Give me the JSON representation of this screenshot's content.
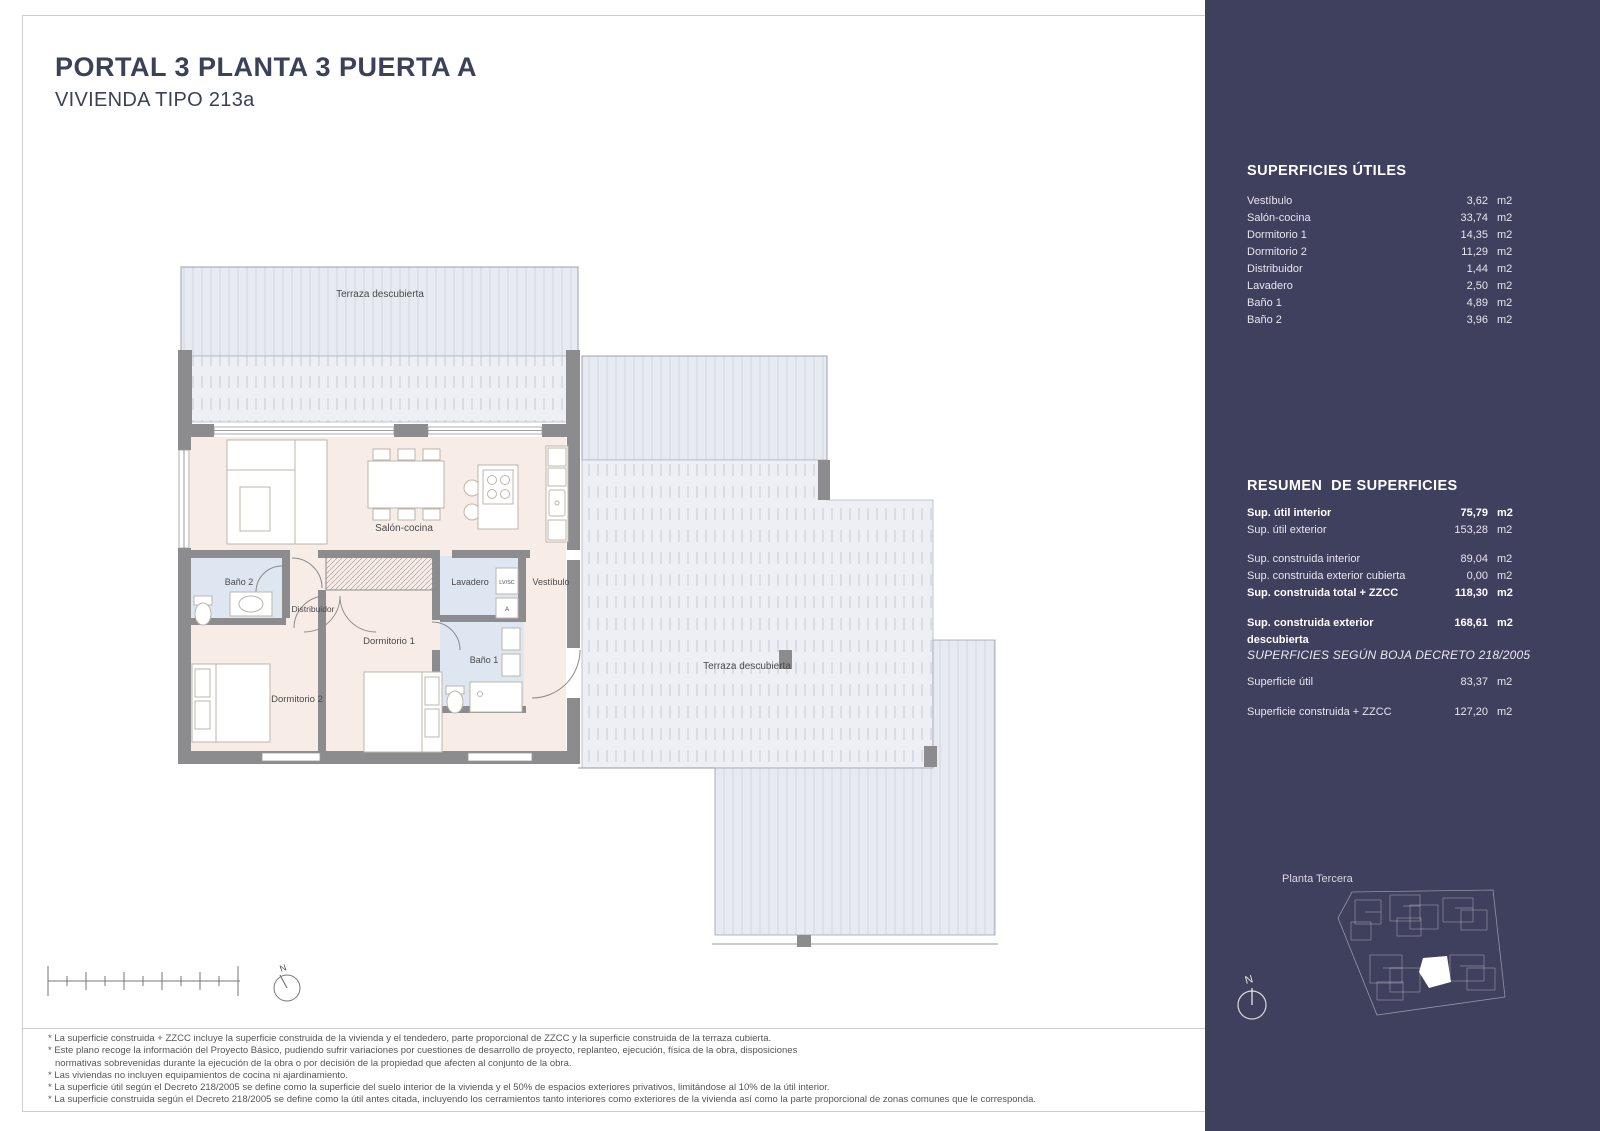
{
  "header": {
    "title": "PORTAL 3  PLANTA 3 PUERTA A",
    "subtitle": "VIVIENDA TIPO 213a"
  },
  "plan": {
    "rooms": {
      "terraza_top": "Terraza descubierta",
      "salon": "Salón-cocina",
      "bano2": "Baño 2",
      "distribuidor": "Distribuidor",
      "lavadero": "Lavadero",
      "vestibulo": "Vestíbulo",
      "dormitorio1": "Dormitorio 1",
      "bano1": "Baño 1",
      "dormitorio2": "Dormitorio 2",
      "terraza_right": "Terraza descubierta"
    },
    "appliances": {
      "washer": "LV/SC",
      "boiler": "A"
    },
    "north_letter": "N"
  },
  "sidebar": {
    "unit": "m2",
    "superficies_utiles": {
      "title": "SUPERFICIES ÚTILES",
      "rows": [
        {
          "label": "Vestíbulo",
          "value": "3,62"
        },
        {
          "label": "Salón-cocina",
          "value": "33,74"
        },
        {
          "label": "Dormitorio 1",
          "value": "14,35"
        },
        {
          "label": "Dormitorio 2",
          "value": "11,29"
        },
        {
          "label": "Distribuidor",
          "value": "1,44"
        },
        {
          "label": "Lavadero",
          "value": "2,50"
        },
        {
          "label": "Baño 1",
          "value": "4,89"
        },
        {
          "label": "Baño 2",
          "value": "3,96"
        }
      ]
    },
    "resumen": {
      "title": "RESUMEN  DE SUPERFICIES",
      "rows": [
        {
          "label": "Sup. útil interior",
          "value": "75,79"
        },
        {
          "label": "Sup. útil exterior",
          "value": "153,28"
        },
        {
          "label": "Sup. construida interior",
          "value": "89,04"
        },
        {
          "label": "Sup. construida exterior cubierta",
          "value": "0,00"
        },
        {
          "label": "Sup. construida total + ZZCC",
          "value": "118,30"
        },
        {
          "label": "Sup. construida exterior descubierta",
          "value": "168,61"
        }
      ]
    },
    "boja": {
      "title": "SUPERFICIES SEGÚN BOJA DECRETO 218/2005",
      "rows": [
        {
          "label": "Superficie útil",
          "value": "83,37"
        },
        {
          "label": "Superficie construida + ZZCC",
          "value": "127,20"
        }
      ]
    },
    "site_plan": {
      "label": "Planta Tercera",
      "north_letter": "N"
    }
  },
  "footnotes": [
    "* La superficie construida + ZZCC incluye la superficie construida de la vivienda y el tendedero, parte proporcional de ZZCC y la superficie construida de la terraza cubierta.",
    "* Este plano recoge la información del Proyecto Básico, pudiendo sufrir variaciones por cuestiones de desarrollo de proyecto, replanteo, ejecución, física de la obra, disposiciones",
    "normativas sobrevenidas durante la ejecución de la obra o por decisión de la propiedad que afecten al conjunto de la obra.",
    "* Las viviendas no incluyen equipamientos de cocina ni ajardinamiento.",
    "* La superficie útil según el Decreto 218/2005 se define como la superficie del suelo interior de la vivienda y el 50% de espacios exteriores privativos, limitándose al 10% de la útil interior.",
    "* La superficie construida según el Decreto 218/2005 se define como la útil antes citada, incluyendo los cerramientos tanto interiores como exteriores de la vivienda así como la parte proporcional de zonas comunes que le corresponda."
  ],
  "colors": {
    "sidebar_navy": "#3f3f5e",
    "floor_pink": "#f8ece7",
    "floor_blue": "#dde6f1",
    "terrace_fill": "#e8eaf1",
    "wall_gray": "#8c8c8f",
    "title_text": "#3a4158"
  }
}
